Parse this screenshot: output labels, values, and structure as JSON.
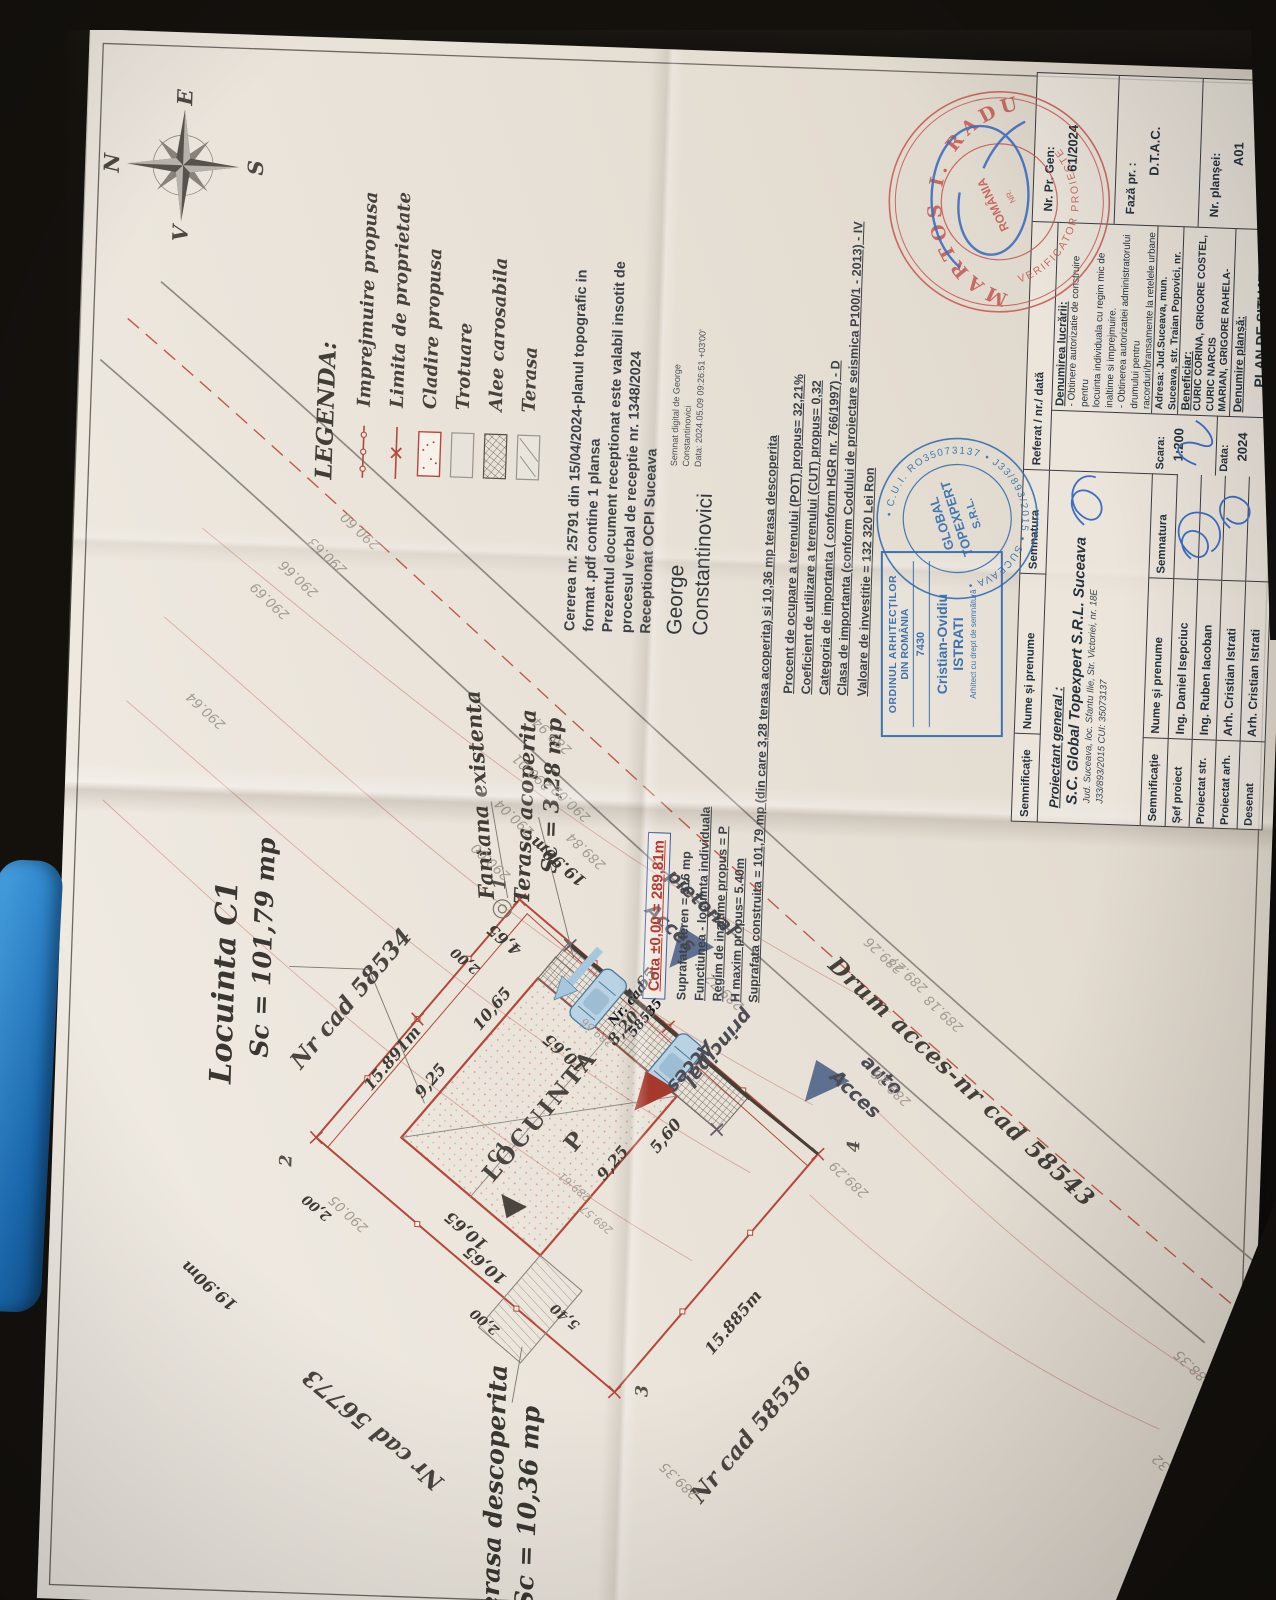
{
  "compass": {
    "n": "N",
    "e": "E",
    "s": "S",
    "v": "V"
  },
  "legend": {
    "title": "LEGENDA:",
    "items": [
      {
        "label": "Imprejmuire propusa",
        "type": "fence"
      },
      {
        "label": "Limita de proprietate",
        "type": "limit"
      },
      {
        "label": "Cladire propusa",
        "type": "building"
      },
      {
        "label": "Trotuare",
        "type": "sidewalk"
      },
      {
        "label": "Alee carosabila",
        "type": "driveway"
      },
      {
        "label": "Terasa",
        "type": "terrace"
      }
    ]
  },
  "ocpi": {
    "lines": [
      {
        "t": "Cererea nr. 25791 din 15/04/2024-planul topografic in"
      },
      {
        "t": "format .pdf  contine 1 plansa"
      },
      {
        "t": "Prezentul document receptionat este valabil insotit de"
      },
      {
        "t": "procesul verbal de receptie nr. 1348/2024"
      },
      {
        "t": "Receptionat OCPI Suceava"
      }
    ],
    "signer_first": "George",
    "signer_last": "Constantinovici",
    "signature_note": [
      {
        "t": "Semnat digital de George"
      },
      {
        "t": "Constantinovici"
      },
      {
        "t": "Data: 2024.05.09 09:26:51 +03'00'"
      }
    ]
  },
  "site_data": {
    "cota": "Cota ±0,00 = 289,81m",
    "lines": [
      {
        "t": "Suprafata teren = 316 mp"
      },
      {
        "t": "Functiunea - locuinta individuala",
        "u": 1
      },
      {
        "t": "Regim de inaltime propus = P",
        "u": 1
      },
      {
        "t": "H maxim propus= 5.40m",
        "u": 1
      },
      {
        "t": "Suprafata construita = 101,79 mp (din care 3,28 terasa acoperita) si 10,36 mp terasa descoperita",
        "u": 1
      }
    ]
  },
  "urbanism": {
    "lines": [
      {
        "t": "Procent de ocupare a terenului (POT) propus= 32,21%",
        "u": 1
      },
      {
        "t": "Coeficient de utilizare a terenului (CUT) propus=  0,32",
        "u": 1
      },
      {
        "t": "Categoria de importanta ( conform HGR nr. 766/1997)  -  D",
        "u": 1
      },
      {
        "t": "Clasa de importanta  (conform Codului de proiectare seismica P100/1 - 2013) - IV",
        "u": 1
      }
    ],
    "valoare": "Valoare de investitie = 132 320 Lei Ron"
  },
  "stamps": {
    "oar": {
      "line1": "ORDINUL ARHITECȚILOR",
      "line2": "DIN ROMÂNIA",
      "number": "7430",
      "name": "Cristian-Ovidiu",
      "surname": "ISTRATI",
      "note": "Arhitect cu drept de semnătură"
    },
    "topexpert": {
      "ring": "• C.U.I. RO35073137 •  J33/893/2015  • SUCEAVA •",
      "center1": "GLOBAL",
      "center2": "TOPEXPERT",
      "center3": "S.R.L."
    },
    "verificator": {
      "ring_top": "MARTOS I. RADU",
      "ring_bottom": "VERIFICATOR PROIECTE",
      "center": "ROMÂNIA"
    }
  },
  "cartus": {
    "col_semnificatie": "Semnificație",
    "col_nume": "Nume și prenume",
    "col_semnatura": "Semnatura",
    "col_referat": "Referat / nr./ dată",
    "proiectant_label": "Proiectant general :",
    "proiectant_name": "S.C. Global Topexpert S.R.L. Suceava",
    "proiectant_addr": "Jud. Suceava, loc. Sfantu Ilie, Str. Victoriei, nr. 18E",
    "proiectant_reg": "J33/893/2015 CUI: 35073137",
    "rows": [
      {
        "role": "Șef proiect",
        "name": "Ing. Daniel Isepciuc"
      },
      {
        "role": "Proiectat str.",
        "name": "Ing. Ruben Iacoban"
      },
      {
        "role": "Proiectat arh.",
        "name": "Arh. Cristian Istrati"
      },
      {
        "role": "Desenat",
        "name": "Arh. Cristian Istrati"
      }
    ],
    "scara_label": "Scara:",
    "scara": "1:200",
    "data_label": "Data:",
    "data": "2024",
    "denumire_label": "Denumirea lucrării:",
    "denumire_lines": [
      "- Obtinere autorizatie de construire pentru",
      "locuinta individuala cu regim mic de inaltime si imprejmuire.",
      "- Obtinerea autorizatiei administratorului drumului pentru",
      "racorduri/bransamente la retelele urbane de utilitati"
    ],
    "adresa": "Adresa: Jud.Suceava, mun. Suceava, str. Traian Popovici, nr. cad. 58535",
    "beneficiar_label": "Beneficiar:",
    "beneficiar_lines": [
      "CURIC CORINA, GRIGORE COSTEL, CURIC NARCIS",
      "MARIAN, GRIGORE RAHELA-DANIELA"
    ],
    "plansa_label": "Denumire planșă:",
    "plansa": "PLAN DE SITUATIE",
    "nr_pr_gen_label": "Nr. Pr. Gen:",
    "nr_pr_gen": "61/2024",
    "faza_label": "Fază pr. :",
    "faza": "D.T.A.C.",
    "nr_plansei_label": "Nr. planșei:",
    "nr_plansei": "A01"
  },
  "plan": {
    "labels": [
      {
        "t": "Locuinta C1",
        "x": 622,
        "y": 168,
        "r": 0,
        "c": "big"
      },
      {
        "t": "Sc = 101,79 mp",
        "x": 658,
        "y": 205,
        "r": 0,
        "c": "big2"
      },
      {
        "t": "Nr cad 58534",
        "x": 610,
        "y": 295,
        "r": 38,
        "c": "cad"
      },
      {
        "t": "15.891m",
        "x": 552,
        "y": 338,
        "r": 38,
        "c": "dim"
      },
      {
        "t": "9,25",
        "x": 531,
        "y": 377,
        "r": 38,
        "c": "dim"
      },
      {
        "t": "10,65",
        "x": 605,
        "y": 436,
        "r": 38,
        "c": "dim"
      },
      {
        "t": "Fantana existenta",
        "x": 818,
        "y": 416,
        "r": -6,
        "c": "med"
      },
      {
        "t": "Terasa acoperita",
        "x": 808,
        "y": 462,
        "r": 0,
        "c": "med"
      },
      {
        "t": "Sc = 3,28 mp",
        "x": 820,
        "y": 488,
        "r": 0,
        "c": "med"
      },
      {
        "t": "1",
        "x": 730,
        "y": 440,
        "r": 0,
        "c": "pt"
      },
      {
        "t": "2",
        "x": 446,
        "y": 236,
        "r": 0,
        "c": "pt"
      },
      {
        "t": "3",
        "x": 228,
        "y": 600,
        "r": 0,
        "c": "pt"
      },
      {
        "t": "4",
        "x": 480,
        "y": 803,
        "r": 0,
        "c": "pt"
      },
      {
        "t": "19.90m",
        "x": 754,
        "y": 497,
        "r": -52,
        "c": "dim"
      },
      {
        "t": "19.90m",
        "x": 318,
        "y": 163,
        "r": -52,
        "c": "dim"
      },
      {
        "t": "2,00",
        "x": 652,
        "y": 408,
        "r": -52,
        "c": "dimS"
      },
      {
        "t": "2,00",
        "x": 400,
        "y": 268,
        "r": -52,
        "c": "dimS"
      },
      {
        "t": "2,00",
        "x": 292,
        "y": 440,
        "r": -52,
        "c": "dimS"
      },
      {
        "t": "4,65",
        "x": 674,
        "y": 446,
        "r": -52,
        "c": "dim"
      },
      {
        "t": "4,65",
        "x": 634,
        "y": 584,
        "r": 38,
        "c": "dim"
      },
      {
        "t": "8,20",
        "x": 590,
        "y": 568,
        "r": 38,
        "c": "dim"
      },
      {
        "t": "10,65",
        "x": 563,
        "y": 510,
        "r": -52,
        "c": "dim"
      },
      {
        "t": "10,65",
        "x": 382,
        "y": 418,
        "r": -52,
        "c": "dim"
      },
      {
        "t": "10,65",
        "x": 348,
        "y": 438,
        "r": -52,
        "c": "dim"
      },
      {
        "t": "9,25",
        "x": 455,
        "y": 562,
        "r": 38,
        "c": "dim"
      },
      {
        "t": "5,60",
        "x": 484,
        "y": 614,
        "r": 38,
        "c": "dim"
      },
      {
        "t": "5,40",
        "x": 300,
        "y": 520,
        "r": -52,
        "c": "dimS"
      },
      {
        "t": "15.885m",
        "x": 300,
        "y": 688,
        "r": 38,
        "c": "dim"
      },
      {
        "t": "Nr cad 58536",
        "x": 190,
        "y": 710,
        "r": 38,
        "c": "cad"
      },
      {
        "t": "Nr cad 56773",
        "x": 180,
        "y": 332,
        "r": -52,
        "c": "cad"
      },
      {
        "t": "Terasa descoperita",
        "x": 118,
        "y": 455,
        "r": 0,
        "c": "big2"
      },
      {
        "t": "Sc = 10,36 mp",
        "x": 108,
        "y": 489,
        "r": 0,
        "c": "big2"
      },
      {
        "t": "C1",
        "x": 462,
        "y": 447,
        "r": 38,
        "c": "bldS"
      },
      {
        "t": "LOCUINTA",
        "x": 500,
        "y": 488,
        "r": 38,
        "c": "bld"
      },
      {
        "t": "P",
        "x": 476,
        "y": 524,
        "r": 38,
        "c": "bld"
      },
      {
        "t": "Nr. cad",
        "x": 614,
        "y": 572,
        "r": 38,
        "c": "cadS"
      },
      {
        "t": "58535",
        "x": 601,
        "y": 590,
        "r": 38,
        "c": "cadS"
      },
      {
        "t": "Drum acces-nr cad 58543",
        "x": 548,
        "y": 908,
        "r": 131,
        "c": "road"
      },
      {
        "t": "Acces",
        "x": 692,
        "y": 612,
        "r": 131,
        "c": "acc"
      },
      {
        "t": "pietonal",
        "x": 718,
        "y": 642,
        "r": 131,
        "c": "acc"
      },
      {
        "t": "Acces",
        "x": 554,
        "y": 636,
        "r": 218,
        "c": "acc"
      },
      {
        "t": "principal",
        "x": 574,
        "y": 664,
        "r": 218,
        "c": "acc"
      },
      {
        "t": "Acces",
        "x": 532,
        "y": 802,
        "r": 131,
        "c": "acc"
      },
      {
        "t": "auto",
        "x": 552,
        "y": 828,
        "r": 131,
        "c": "acc"
      },
      {
        "t": "290.69",
        "x": 1005,
        "y": 200,
        "r": -49,
        "c": "elev"
      },
      {
        "t": "290.66",
        "x": 1028,
        "y": 228,
        "r": -49,
        "c": "elev"
      },
      {
        "t": "290.63",
        "x": 1052,
        "y": 256,
        "r": -49,
        "c": "elev"
      },
      {
        "t": "290.60",
        "x": 1078,
        "y": 288,
        "r": -49,
        "c": "elev"
      },
      {
        "t": "290.64",
        "x": 893,
        "y": 140,
        "r": -49,
        "c": "elev"
      },
      {
        "t": "290.05",
        "x": 395,
        "y": 300,
        "r": -49,
        "c": "elev"
      },
      {
        "t": "290.00",
        "x": 752,
        "y": 430,
        "r": -49,
        "c": "elev"
      },
      {
        "t": "290.04",
        "x": 797,
        "y": 452,
        "r": -49,
        "c": "elev"
      },
      {
        "t": "290.01",
        "x": 843,
        "y": 468,
        "r": -49,
        "c": "elev"
      },
      {
        "t": "289.94",
        "x": 880,
        "y": 487,
        "r": -49,
        "c": "elev"
      },
      {
        "t": "290.02",
        "x": 813,
        "y": 508,
        "r": -49,
        "c": "elev"
      },
      {
        "t": "289.84",
        "x": 766,
        "y": 525,
        "r": -49,
        "c": "elev"
      },
      {
        "t": "289.72",
        "x": 630,
        "y": 668,
        "r": -49,
        "c": "elev"
      },
      {
        "t": "289.26",
        "x": 672,
        "y": 826,
        "r": -49,
        "c": "elev"
      },
      {
        "t": "289.27",
        "x": 654,
        "y": 851,
        "r": -49,
        "c": "elev"
      },
      {
        "t": "289.18",
        "x": 616,
        "y": 888,
        "r": -49,
        "c": "elev"
      },
      {
        "t": "289.26",
        "x": 540,
        "y": 838,
        "r": -49,
        "c": "elev"
      },
      {
        "t": "289.29",
        "x": 447,
        "y": 799,
        "r": -49,
        "c": "elev"
      },
      {
        "t": "289.35",
        "x": 140,
        "y": 640,
        "r": -49,
        "c": "elev"
      },
      {
        "t": "288.32",
        "x": 165,
        "y": 1132,
        "r": -49,
        "c": "elev"
      },
      {
        "t": "288.35",
        "x": 270,
        "y": 1150,
        "r": -49,
        "c": "elev"
      },
      {
        "t": "289.61",
        "x": 430,
        "y": 525,
        "r": -52,
        "c": "elevS"
      },
      {
        "t": "289.57",
        "x": 398,
        "y": 548,
        "r": -52,
        "c": "elevS"
      },
      {
        "t": "289.56",
        "x": 585,
        "y": 542,
        "r": -52,
        "c": "elevS"
      }
    ]
  }
}
